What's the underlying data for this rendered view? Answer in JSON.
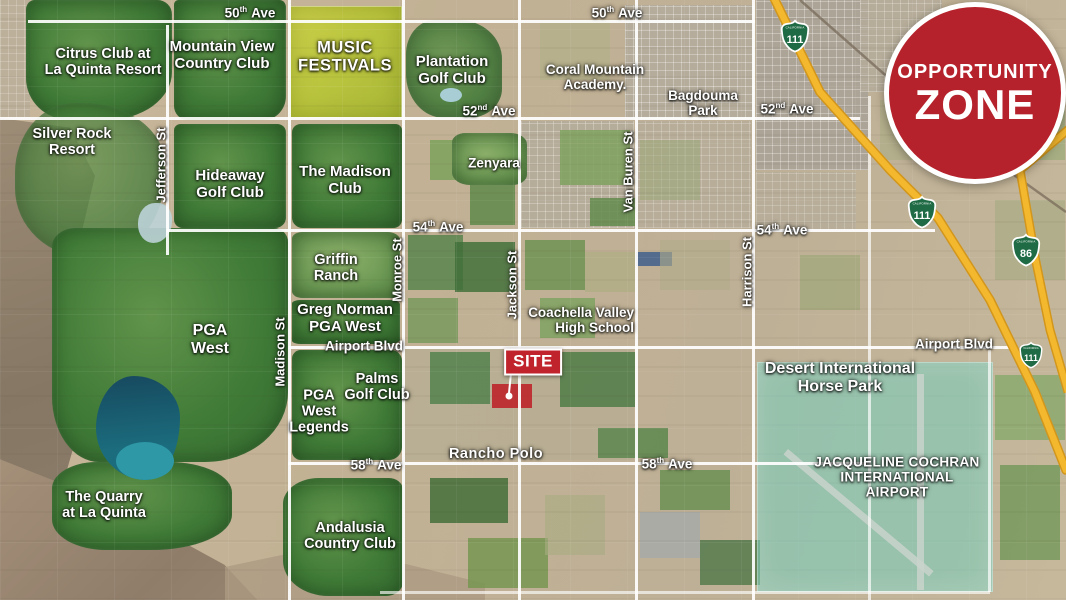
{
  "map": {
    "regions": [
      {
        "name": "citrus-club",
        "lines": [
          "Citrus Club at",
          "La Quinta Resort"
        ]
      },
      {
        "name": "mountain-view",
        "lines": [
          "Mountain View",
          "Country Club"
        ]
      },
      {
        "name": "music-festivals",
        "lines": [
          "MUSIC",
          "FESTIVALS"
        ]
      },
      {
        "name": "plantation-golf-club",
        "lines": [
          "Plantation",
          "Golf Club"
        ]
      },
      {
        "name": "coral-mountain-academy",
        "lines": [
          "Coral Mountain",
          "Academy."
        ]
      },
      {
        "name": "bagdouma-park",
        "lines": [
          "Bagdouma",
          "Park"
        ]
      },
      {
        "name": "silver-rock-resort",
        "lines": [
          "Silver Rock",
          "Resort"
        ]
      },
      {
        "name": "hideaway-golf-club",
        "lines": [
          "Hideaway",
          "Golf Club"
        ]
      },
      {
        "name": "the-madison-club",
        "lines": [
          "The Madison",
          "Club"
        ]
      },
      {
        "name": "zenyara",
        "lines": [
          "Zenyara"
        ]
      },
      {
        "name": "griffin-ranch",
        "lines": [
          "Griffin",
          "Ranch"
        ]
      },
      {
        "name": "greg-norman-pga-west",
        "lines": [
          "Greg Norman",
          "PGA West"
        ]
      },
      {
        "name": "pga-west",
        "lines": [
          "PGA",
          "West"
        ]
      },
      {
        "name": "coachella-valley-high-school",
        "lines": [
          "Coachella Valley",
          "High School"
        ]
      },
      {
        "name": "desert-international-horse-park",
        "lines": [
          "Desert International",
          "Horse Park"
        ]
      },
      {
        "name": "palms-golf-club",
        "lines": [
          "Palms",
          "Golf Club"
        ]
      },
      {
        "name": "pga-west-legends",
        "lines": [
          "PGA",
          "West",
          "Legends"
        ]
      },
      {
        "name": "rancho-polo",
        "lines": [
          "Rancho Polo"
        ]
      },
      {
        "name": "the-quarry",
        "lines": [
          "The Quarry",
          "at La Quinta"
        ]
      },
      {
        "name": "andalusia-country-club",
        "lines": [
          "Andalusia",
          "Country Club"
        ]
      },
      {
        "name": "jacqueline-cochran-airport",
        "lines": [
          "JACQUELINE COCHRAN",
          "INTERNATIONAL",
          "AIRPORT"
        ]
      }
    ],
    "streets_vertical": [
      {
        "label": "Jefferson St"
      },
      {
        "label": "Madison St"
      },
      {
        "label": "Monroe St"
      },
      {
        "label": "Jackson St"
      },
      {
        "label": "Van Buren St"
      },
      {
        "label": "Harrison St"
      }
    ],
    "avenues": [
      {
        "num": "50",
        "ord": "th",
        "word": "Ave",
        "pos": "west"
      },
      {
        "num": "50",
        "ord": "th",
        "word": "Ave",
        "pos": "east"
      },
      {
        "num": "52",
        "ord": "nd",
        "word": "Ave",
        "pos": "west"
      },
      {
        "num": "52",
        "ord": "nd",
        "word": "Ave",
        "pos": "east"
      },
      {
        "num": "54",
        "ord": "th",
        "word": "Ave",
        "pos": "west"
      },
      {
        "num": "54",
        "ord": "th",
        "word": "Ave",
        "pos": "east"
      },
      {
        "num": "58",
        "ord": "th",
        "word": "Ave",
        "pos": "west"
      },
      {
        "num": "58",
        "ord": "th",
        "word": "Ave",
        "pos": "east"
      }
    ],
    "boulevards": [
      {
        "label": "Airport Blvd",
        "pos": "west"
      },
      {
        "label": "Airport Blvd",
        "pos": "east"
      }
    ],
    "highways": [
      {
        "state": "CALIFORNIA",
        "number": "111",
        "pos": "top"
      },
      {
        "state": "CALIFORNIA",
        "number": "111",
        "pos": "middle"
      },
      {
        "state": "CALIFORNIA",
        "number": "86",
        "pos": "right"
      },
      {
        "state": "CALIFORNIA",
        "number": "111",
        "pos": "lower"
      }
    ],
    "site_marker": {
      "label": "SITE"
    },
    "opportunity_zone": {
      "line1": "OPPORTUNITY",
      "line2": "ZONE"
    },
    "colors": {
      "badge_red": "#b6222b",
      "site_red": "#c0232b",
      "highway_yellow": "#f4b82e",
      "zone_teal": "#71cfbe",
      "festival_yellow": "#c9cf47",
      "golf_green": "#417c38",
      "shield_green": "#1f6b45"
    }
  }
}
